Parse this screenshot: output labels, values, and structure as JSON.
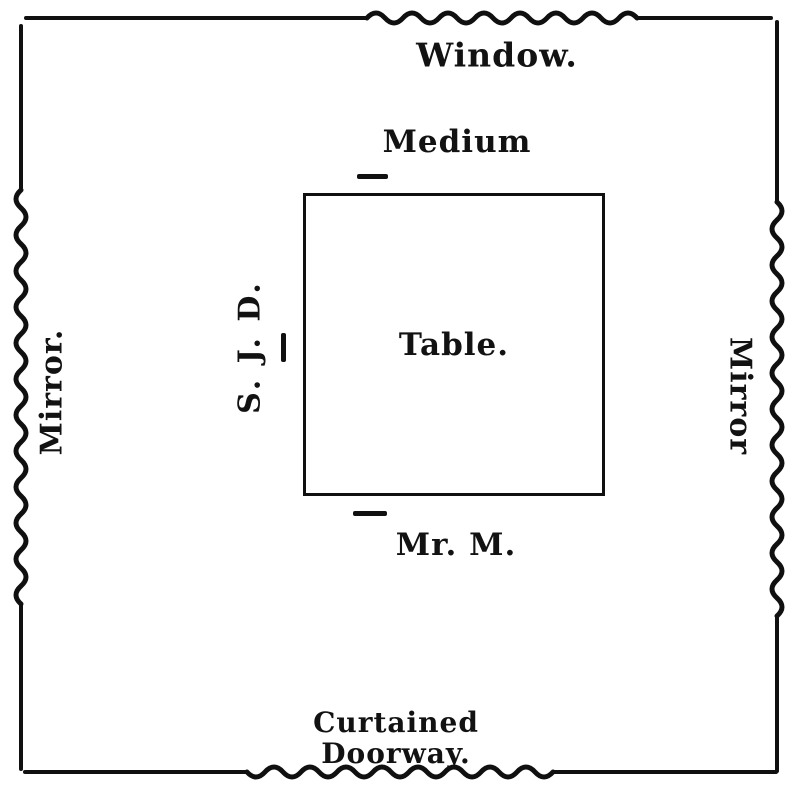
{
  "figure": {
    "window": {
      "label": "Window."
    },
    "mirror_left": {
      "label": "Mirror."
    },
    "mirror_right": {
      "label": "Mirror"
    },
    "doorway": {
      "line1": "Curtained",
      "line2": "Doorway."
    },
    "table": {
      "label": "Table."
    },
    "sitters": {
      "medium": {
        "label": "Medium"
      },
      "sjd": {
        "label": "S. J. D."
      },
      "mr_m": {
        "label": "Mr. M."
      }
    },
    "colors": {
      "ink": "#101010",
      "paper": "#ffffff"
    }
  }
}
